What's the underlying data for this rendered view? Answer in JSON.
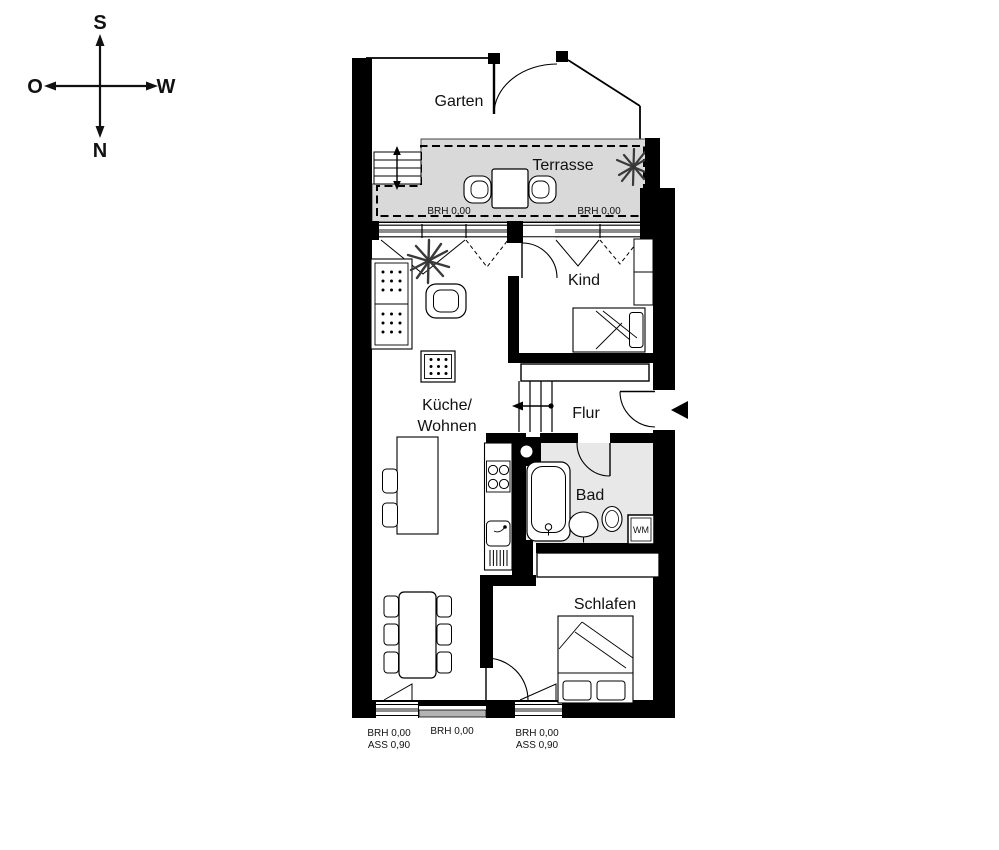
{
  "compass": {
    "south": "S",
    "north": "N",
    "east": "O",
    "west": "W"
  },
  "rooms": {
    "garten": "Garten",
    "terrasse": "Terrasse",
    "kind": "Kind",
    "kueche_line1": "Küche/",
    "kueche_line2": "Wohnen",
    "flur": "Flur",
    "bad": "Bad",
    "schlafen": "Schlafen"
  },
  "appliances": {
    "washing_machine": "WM"
  },
  "sill_labels": {
    "terrasse_left": "BRH 0,00",
    "terrasse_right": "BRH 0,00",
    "south_left_line1": "BRH 0,00",
    "south_left_line2": "ASS 0,90",
    "south_middle": "BRH 0,00",
    "south_right_line1": "BRH 0,00",
    "south_right_line2": "ASS 0,90"
  },
  "colors": {
    "wall": "#000000",
    "terrace_floor": "#d9d9d9",
    "bath_floor": "#e8e8e8",
    "paper": "#ffffff",
    "glazing": "#8c8c8c"
  }
}
